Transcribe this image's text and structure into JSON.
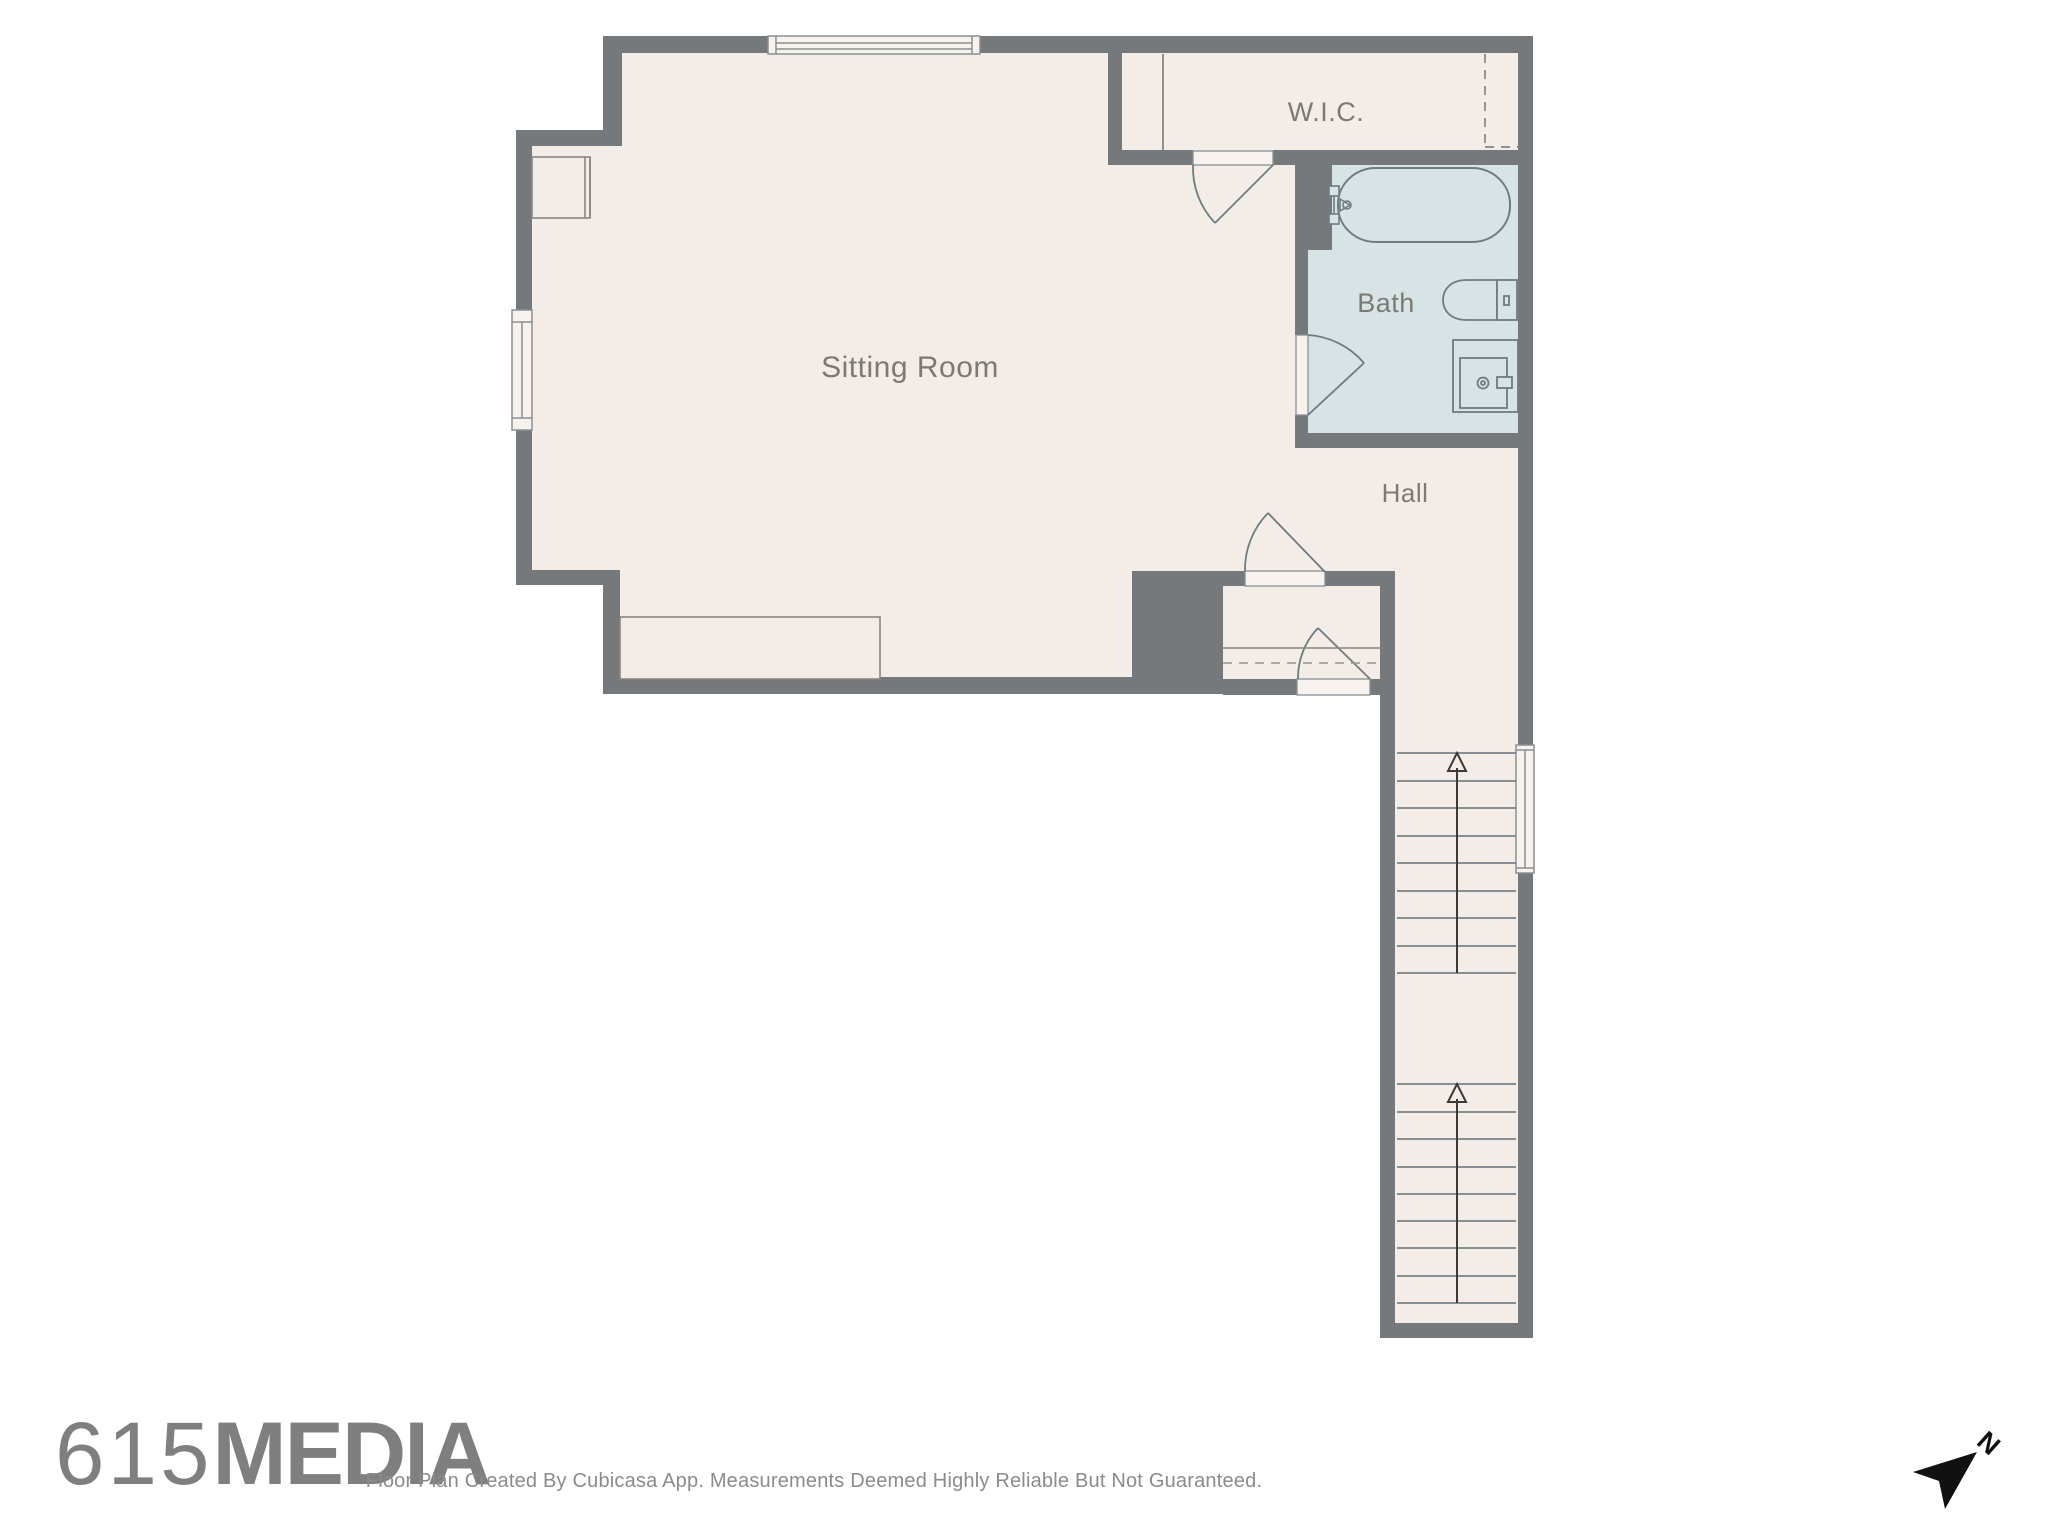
{
  "plan": {
    "rooms": [
      {
        "label": "Sitting Room"
      },
      {
        "label": "W.I.C."
      },
      {
        "label": "Bath"
      },
      {
        "label": "Hall"
      }
    ],
    "stairs": {
      "flights": 2,
      "treads_per_flight": 8,
      "direction": "up"
    },
    "fixtures": [
      "bathtub",
      "tub-faucet",
      "toilet",
      "sink-vanity",
      "closet-shelf",
      "closet-rod",
      "wall-cabinet",
      "built-in-bench"
    ],
    "colors": {
      "wall": "#75797c",
      "floor": "#f4ece7",
      "bath_floor": "#d7e3e4",
      "fixture_line": "#6e7c80",
      "room_label": "#7b7a75",
      "dashed_line": "#96938e"
    }
  },
  "branding": {
    "logo_number": "615",
    "logo_word": "MEDIA"
  },
  "footer": {
    "disclaimer": "Floor Plan Created By Cubicasa App. Measurements Deemed Highly Reliable But Not Guaranteed."
  },
  "compass": {
    "north_label": "N"
  }
}
